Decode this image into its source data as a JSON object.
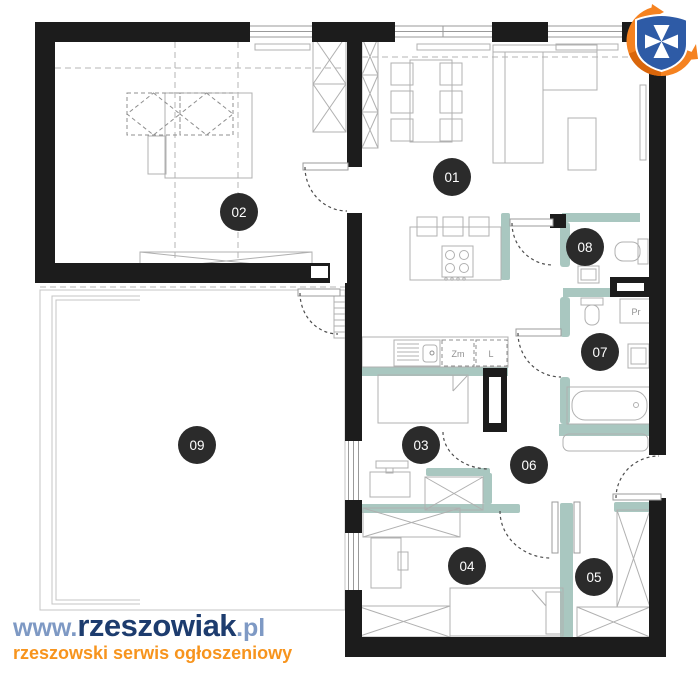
{
  "colors": {
    "wall": "#1c1c1c",
    "accent_wall": "#a9c7c0",
    "furniture_line": "#b0b0b0",
    "badge_bg": "#2b2b2b",
    "badge_text": "#ffffff",
    "watermark_navy": "#1d3c6e",
    "watermark_lightblue": "#7e99c4",
    "watermark_orange": "#f7941d",
    "logo_shield_blue": "#2e5ba6",
    "logo_swoosh_orange": "#f58220"
  },
  "rooms": [
    {
      "id": "01",
      "label": "01"
    },
    {
      "id": "02",
      "label": "02"
    },
    {
      "id": "03",
      "label": "03"
    },
    {
      "id": "04",
      "label": "04"
    },
    {
      "id": "05",
      "label": "05"
    },
    {
      "id": "06",
      "label": "06"
    },
    {
      "id": "07",
      "label": "07"
    },
    {
      "id": "08",
      "label": "08"
    },
    {
      "id": "09",
      "label": "09"
    }
  ],
  "appliance_labels": [
    {
      "id": "dishwasher",
      "text": "Zm"
    },
    {
      "id": "fridge",
      "text": "L"
    },
    {
      "id": "washer",
      "text": "Pr"
    }
  ],
  "watermark": {
    "www": "www.",
    "name": "rzeszowiak",
    "tld": ".pl",
    "tagline": "rzeszowski serwis ogłoszeniowy"
  }
}
